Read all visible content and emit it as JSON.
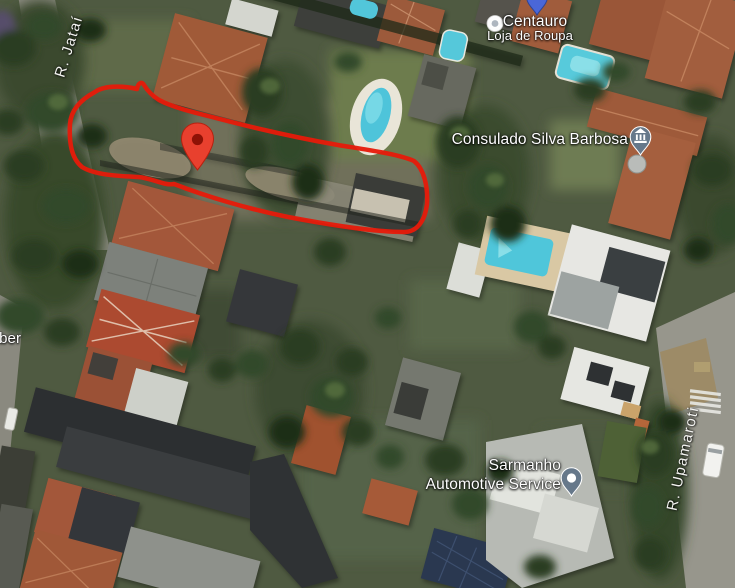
{
  "app": {
    "view": "satellite-map"
  },
  "streets": {
    "jatai": "R. Jataí",
    "upamaroti": "R. Upamaroti"
  },
  "partial_label": "rber",
  "pois": {
    "centauro": {
      "title": "Centauro",
      "subtitle": "Loja de Roupa",
      "icon": "store-circle-icon",
      "pin_icon": "blue-map-pin-icon"
    },
    "consulado": {
      "title": "Consulado Silva Barbosa",
      "icon": "government-building-pin-icon"
    },
    "sarmanho": {
      "title_line1": "Sarmanho",
      "title_line2": "Automotive Service",
      "icon": "generic-poi-pin-icon"
    }
  },
  "annotation": {
    "shape": "hand-drawn-property-outline",
    "color": "#e71a0a"
  },
  "marker": {
    "icon": "red-map-pin-icon",
    "color": "#e8402e",
    "inner_color": "#8e1206"
  },
  "colors": {
    "poi_pin_slate": "#66788a",
    "centauro_pin_blue": "#4a67d8",
    "pool_water": "#52c6da"
  }
}
